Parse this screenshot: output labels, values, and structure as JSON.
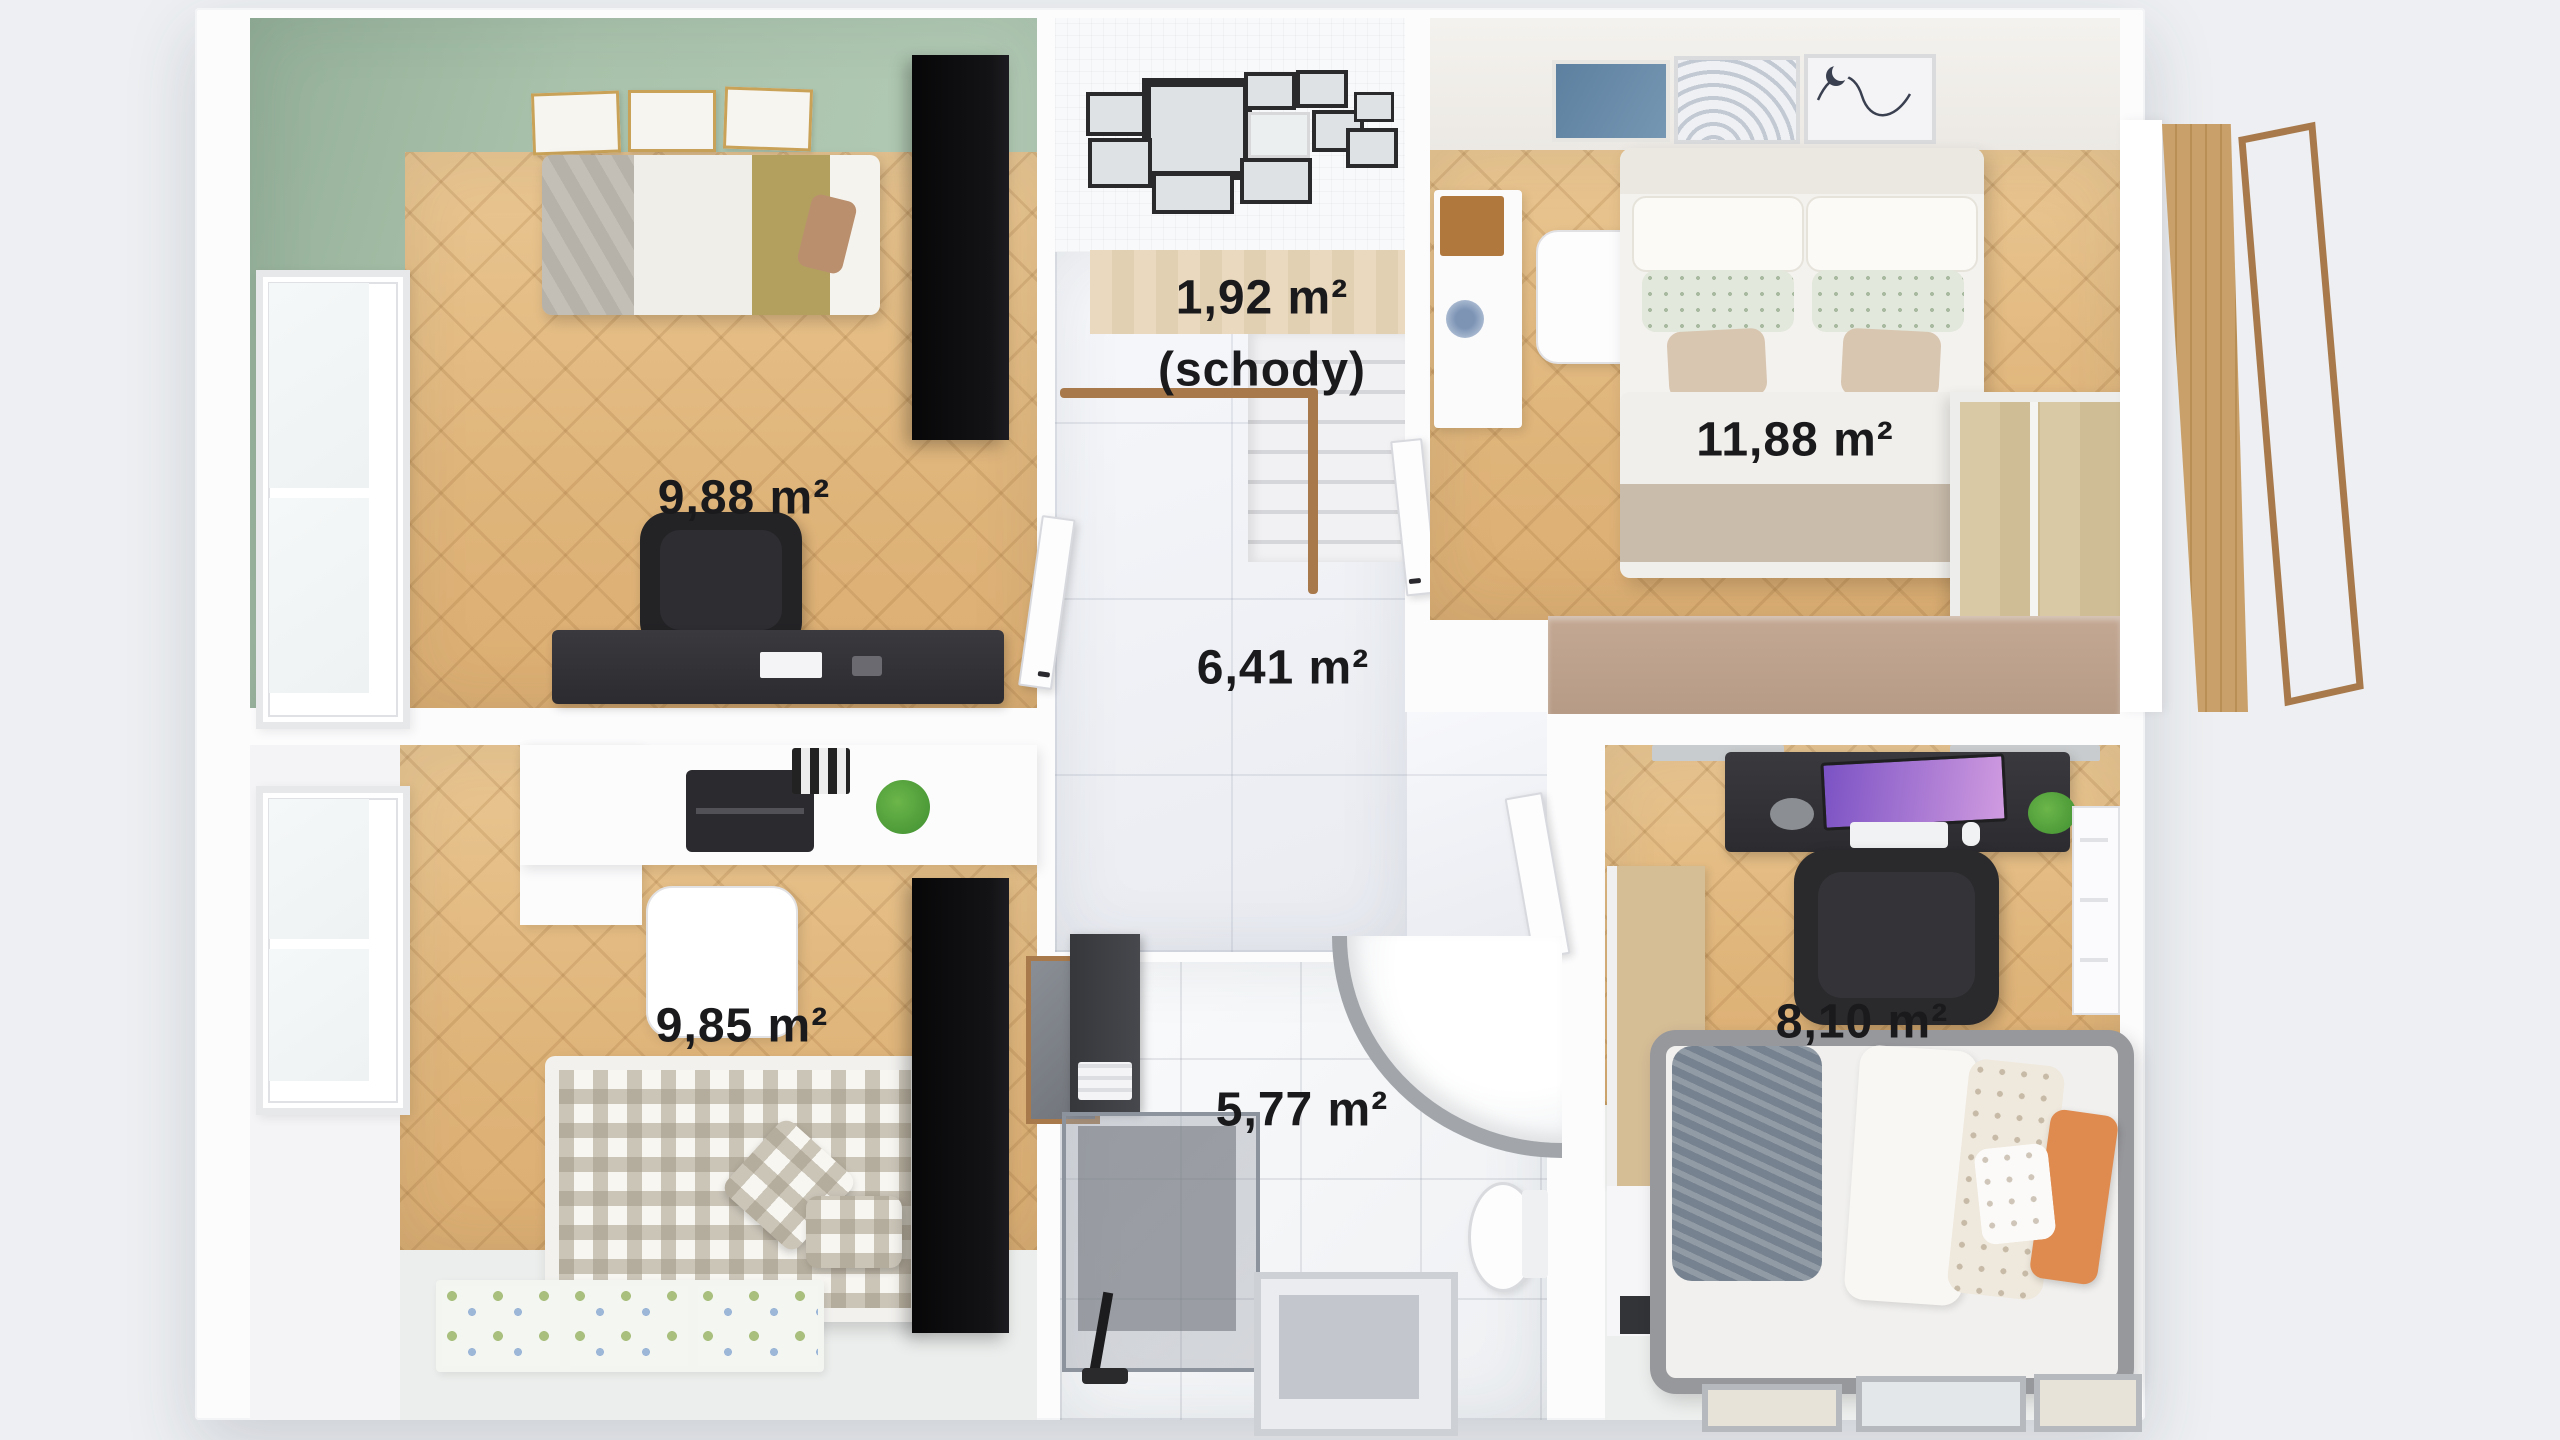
{
  "plan": {
    "background": "#edeff2",
    "label": "#1a1a1d",
    "colors": {
      "wood": "#eac691",
      "green": "#a9c2ab",
      "marble": "#f7f8fb",
      "wall": "#fcfcfd",
      "tan": "#c3a893",
      "dark": "#232326",
      "orange": "#df8a4f",
      "rail": "#a87a4b"
    },
    "rooms": [
      {
        "id": "children-room-1",
        "area_label": "9,88 m²"
      },
      {
        "id": "staircase",
        "area_label": "1,92 m²",
        "sub_label": "(schody)"
      },
      {
        "id": "hallway",
        "area_label": "6,41 m²"
      },
      {
        "id": "bedroom",
        "area_label": "11,88 m²"
      },
      {
        "id": "children-room-2",
        "area_label": "9,85 m²"
      },
      {
        "id": "bathroom",
        "area_label": "5,77 m²"
      },
      {
        "id": "office-room",
        "area_label": "8,10 m²"
      }
    ]
  }
}
